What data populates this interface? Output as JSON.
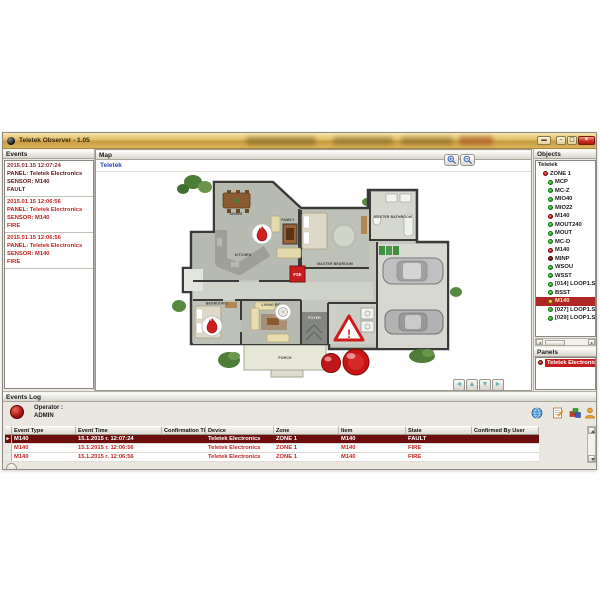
{
  "window": {
    "title": "Teletek Observer - 1.05",
    "controls": [
      {
        "name": "window-menu-button",
        "glyph": "▬"
      },
      {
        "name": "minimize-button",
        "glyph": "–"
      },
      {
        "name": "maximize-button",
        "glyph": "▢"
      },
      {
        "name": "close-button",
        "glyph": "×"
      }
    ]
  },
  "colors": {
    "titlebar_gold": "#d9b45a",
    "ok_green": "#28b428",
    "alarm_red": "#d41c1c",
    "fault_maroon": "#7c1010",
    "warn_yellow": "#e8b81a",
    "selected_row_bg": "#6d0e0e",
    "event_fire_text": "#c32222",
    "event_fault_text": "#5a1a1a",
    "link_blue": "#2a4ab0",
    "panel_selected_bg": "#c41e1e"
  },
  "events_panel": {
    "title": "Events",
    "events": [
      {
        "time": "2015.01.15 12:07:24",
        "panel": "PANEL: Teletek Electronics",
        "sensor": "SENSOR: M140",
        "state": "FAULT",
        "severity": "fault"
      },
      {
        "time": "2015.01.15 12:06:56",
        "panel": "PANEL: Teletek Electronics",
        "sensor": "SENSOR: M140",
        "state": "FIRE",
        "severity": "fire"
      },
      {
        "time": "2015.01.15 12:06:56",
        "panel": "PANEL: Teletek Electronics",
        "sensor": "SENSOR: M140",
        "state": "FIRE",
        "severity": "fire"
      }
    ]
  },
  "map_panel": {
    "title": "Map",
    "tab_label": "Teletek",
    "nav_arrows": [
      "◄",
      "▲",
      "▼",
      "►"
    ],
    "icons": [
      "zoom-in-icon",
      "zoom-out-icon",
      "fire-alarm-icon",
      "smoke-detector-icon",
      "warning-triangle-icon",
      "beacon-icon",
      "fse-box-icon"
    ],
    "plan_labels": {
      "dining": "DINING",
      "kitchen": "KITCHEN",
      "family": "FAMILY",
      "master_bedroom": "MASTER BEDROOM",
      "master_bathroom": "MASTER BATHROOM",
      "bedroom2": "BEDROOM 2",
      "living": "LIVING ROOM",
      "foyer": "FOYER",
      "porch": "PORCH",
      "fse": "FSE",
      "warning": "!"
    }
  },
  "objects_panel": {
    "title": "Objects",
    "root": "Teletek",
    "items": [
      {
        "label": "ZONE 1",
        "status": "fire"
      },
      {
        "label": "MCP",
        "status": "ok"
      },
      {
        "label": "MC-Z",
        "status": "ok"
      },
      {
        "label": "MIO40",
        "status": "ok"
      },
      {
        "label": "MIO22",
        "status": "ok"
      },
      {
        "label": "M140",
        "status": "fire"
      },
      {
        "label": "MOUT240",
        "status": "ok"
      },
      {
        "label": "MOUT",
        "status": "ok"
      },
      {
        "label": "MC-D",
        "status": "ok"
      },
      {
        "label": "M140",
        "status": "fire"
      },
      {
        "label": "MINP",
        "status": "fault"
      },
      {
        "label": "WSOU",
        "status": "ok"
      },
      {
        "label": "WSST",
        "status": "ok"
      },
      {
        "label": "[014] LOOP1.SENSOR",
        "status": "ok"
      },
      {
        "label": "BSST",
        "status": "ok"
      },
      {
        "label": "M140",
        "status": "alert",
        "row": "selected"
      },
      {
        "label": "[027] LOOP1.SENSOR",
        "status": "ok"
      },
      {
        "label": "[029] LOOP1.SENSOR",
        "status": "ok"
      }
    ]
  },
  "panels_panel": {
    "title": "Panels",
    "items": [
      {
        "label": "Teletek Electronics",
        "status": "fire"
      }
    ]
  },
  "events_log": {
    "title": "Events Log",
    "operator_label": "Operator :",
    "operator_name": "ADMIN",
    "toolbar_icons": [
      "globe-icon",
      "edit-note-icon",
      "report-icon",
      "operator-icon"
    ],
    "columns": [
      "Event Type",
      "Event Time",
      "Confirmation Time",
      "Device",
      "Zone",
      "Item",
      "State",
      "Confirmed By User"
    ],
    "rows": [
      {
        "row": "selected",
        "marker": "►",
        "cells": [
          "M140",
          "15.1.2015 г. 12:07:24",
          "",
          "Teletek Electronics",
          "ZONE 1",
          "M140",
          "FAULT",
          ""
        ]
      },
      {
        "marker": "",
        "cells": [
          "M140",
          "15.1.2015 г. 12:06:56",
          "",
          "Teletek Electronics",
          "ZONE 1",
          "M140",
          "FIRE",
          ""
        ]
      },
      {
        "marker": "",
        "cells": [
          "M140",
          "15.1.2015 г. 12:06:56",
          "",
          "Teletek Electronics",
          "ZONE 1",
          "M140",
          "FIRE",
          ""
        ]
      }
    ]
  }
}
